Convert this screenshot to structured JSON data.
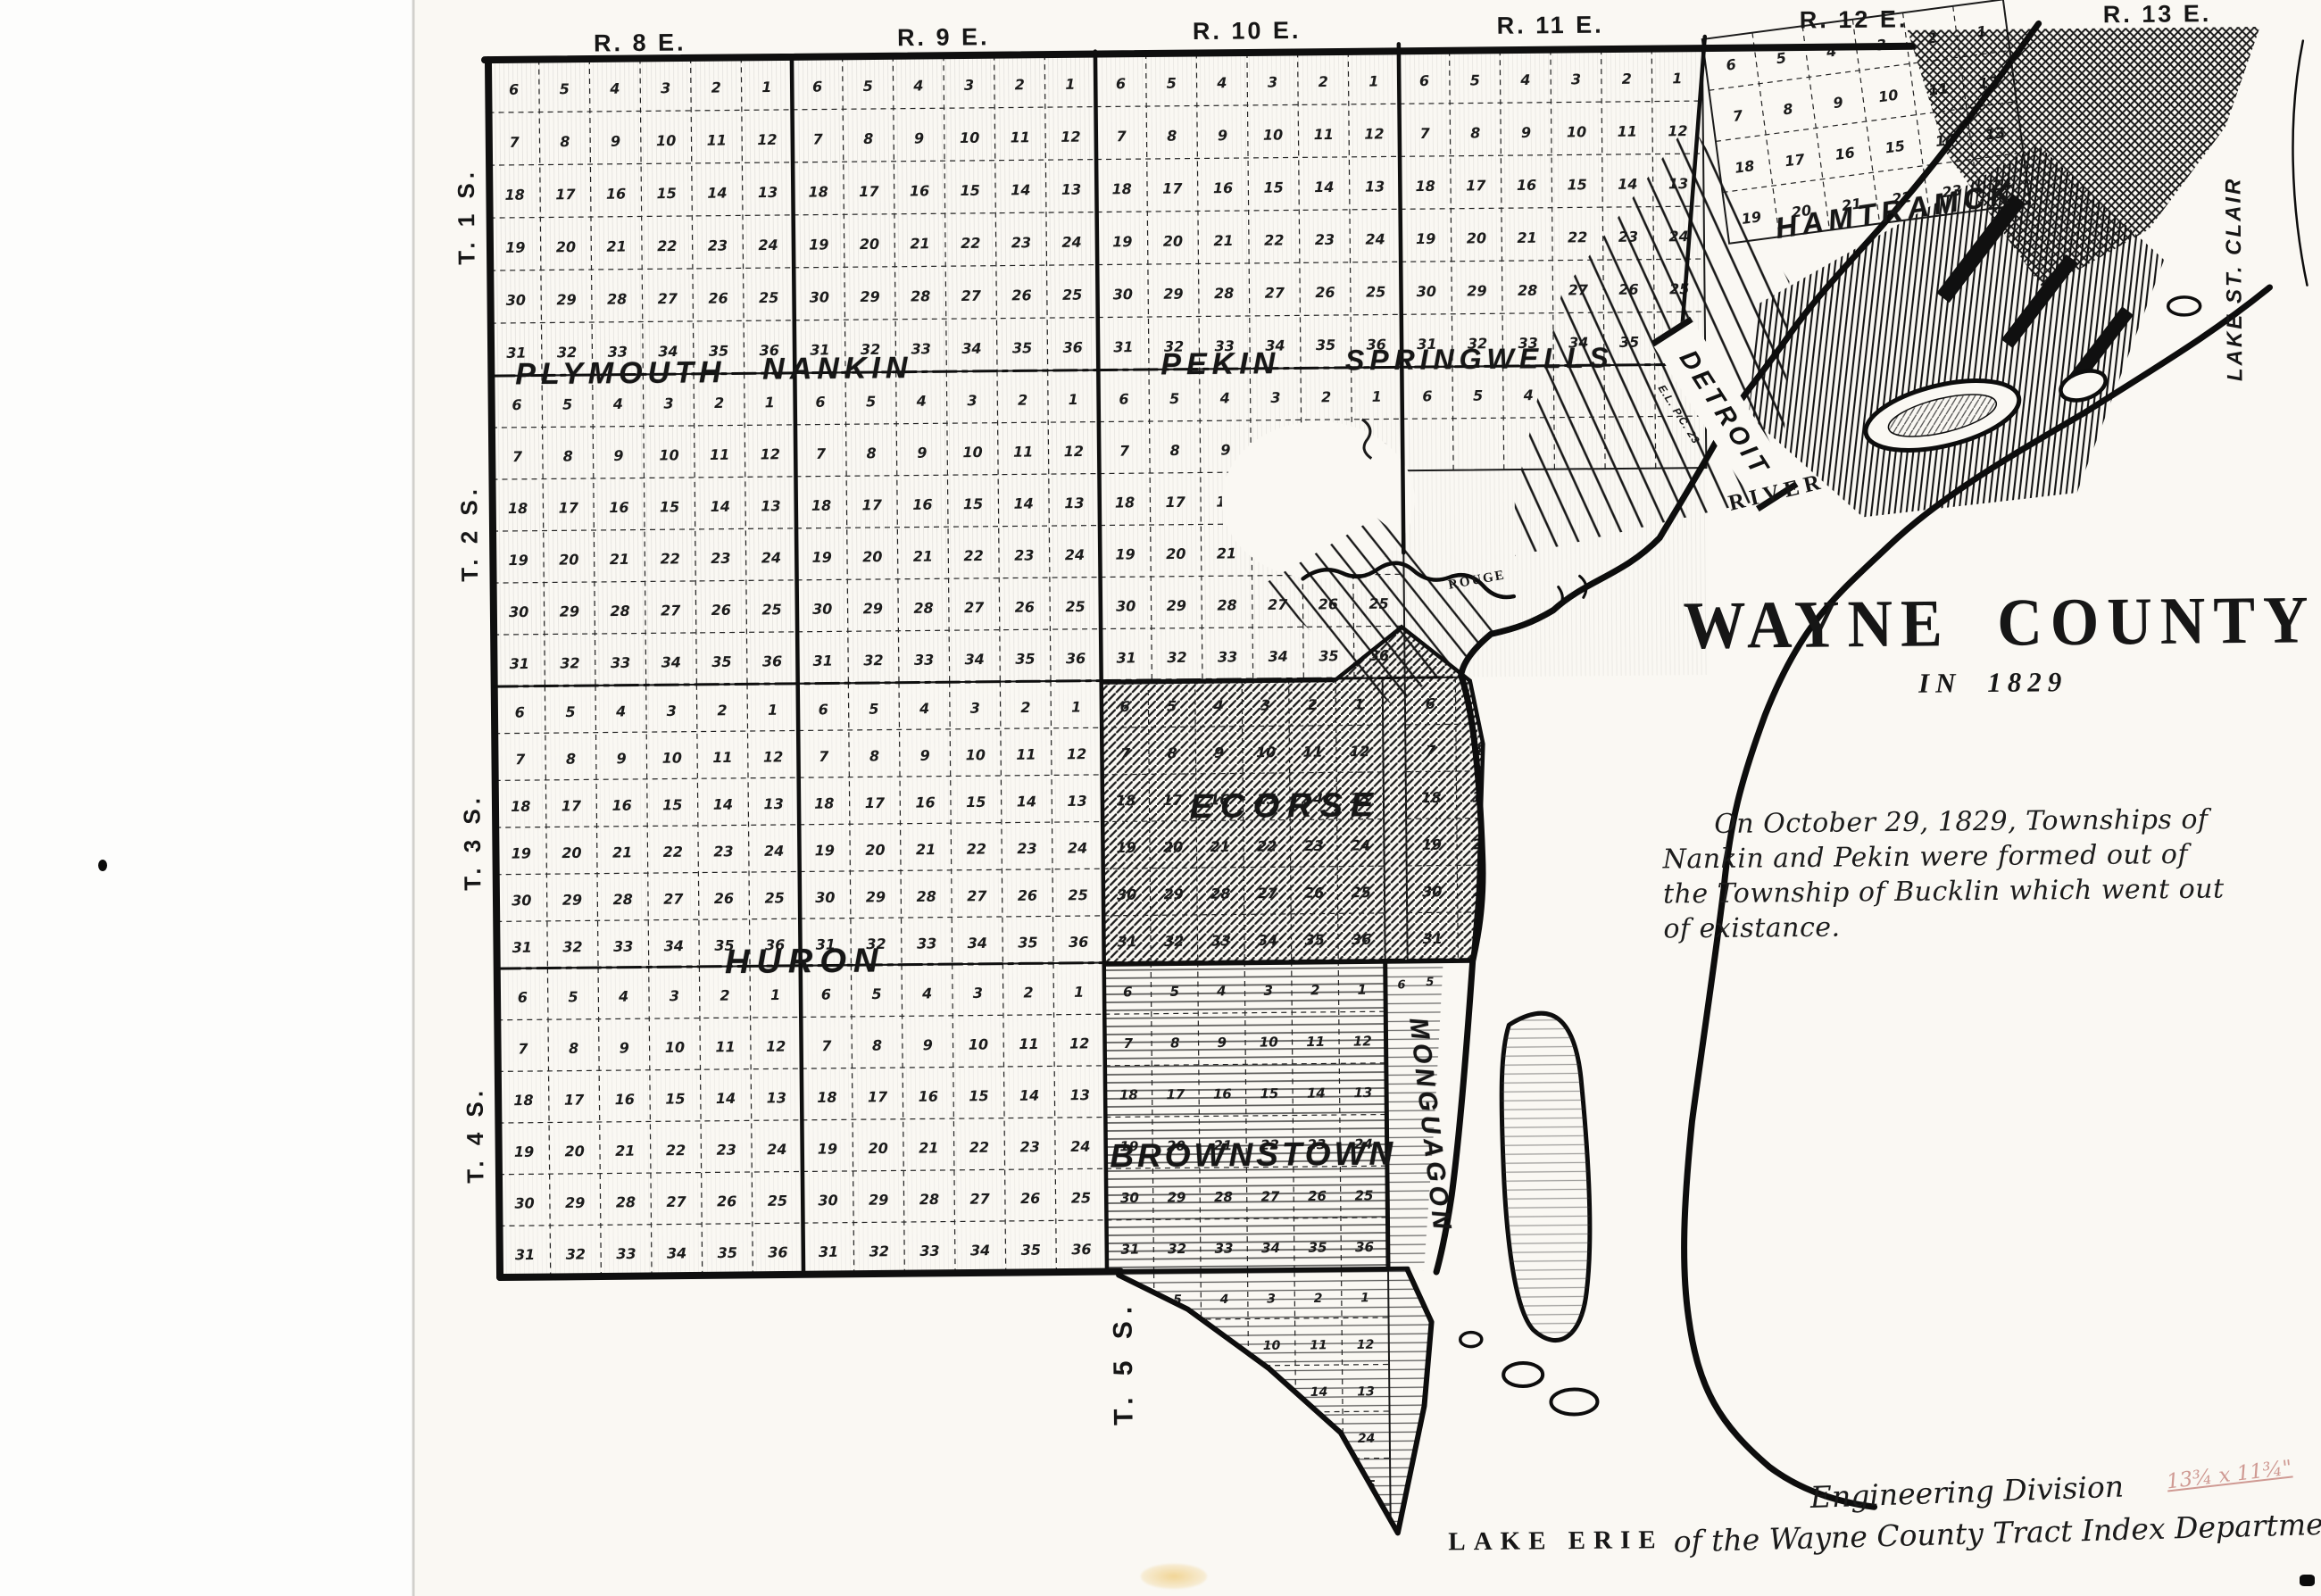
{
  "page": {
    "background": "#fdfdfc",
    "photo_background": "#faf8f3",
    "ink": "#151515"
  },
  "map": {
    "range_headers": [
      "R. 8 E.",
      "R. 9 E.",
      "R. 10 E.",
      "R. 11 E.",
      "R. 12 E.",
      "R. 13 E."
    ],
    "township_row_labels": [
      "T. 1 S.",
      "T. 2 S.",
      "T. 3 S.",
      "T. 4 S.",
      "T. 5 S."
    ],
    "section_rows": [
      [
        6,
        5,
        4,
        3,
        2,
        1
      ],
      [
        7,
        8,
        9,
        10,
        11,
        12
      ],
      [
        18,
        17,
        16,
        15,
        14,
        13
      ],
      [
        19,
        20,
        21,
        22,
        23,
        24
      ],
      [
        30,
        29,
        28,
        27,
        26,
        25
      ],
      [
        31,
        32,
        33,
        34,
        35,
        36
      ]
    ],
    "monguagon_top_sections": [
      6,
      5
    ],
    "townships": [
      {
        "name": "PLYMOUTH"
      },
      {
        "name": "NANKIN"
      },
      {
        "name": "PEKIN"
      },
      {
        "name": "SPRINGWELLS"
      },
      {
        "name": "HAMTRAMCK"
      },
      {
        "name": "DETROIT"
      },
      {
        "name": "ECORSE"
      },
      {
        "name": "HURON"
      },
      {
        "name": "BROWNSTOWN"
      },
      {
        "name": "MONGUAGON"
      }
    ],
    "detroit_strip_note": "E.L. P.C. 23",
    "water_labels": {
      "lake_st_clair": "LAKE ST. CLAIR",
      "river": "RIVER",
      "rouge": "ROUGE",
      "lake_erie": "LAKE ERIE"
    }
  },
  "title_block": {
    "title": "WAYNE COUNTY",
    "subtitle": "IN 1829",
    "note_lines": [
      "On October 29, 1829, Townships of",
      "Nankin and Pekin were formed out of",
      "the Township of Bucklin which went out",
      "of existance."
    ]
  },
  "attribution": {
    "line1": "Engineering Division",
    "line2": "of the Wayne County Tract Index Department",
    "handwritten_note": "13¾ x 11¾\"",
    "handwritten_color": "#c5837c"
  }
}
